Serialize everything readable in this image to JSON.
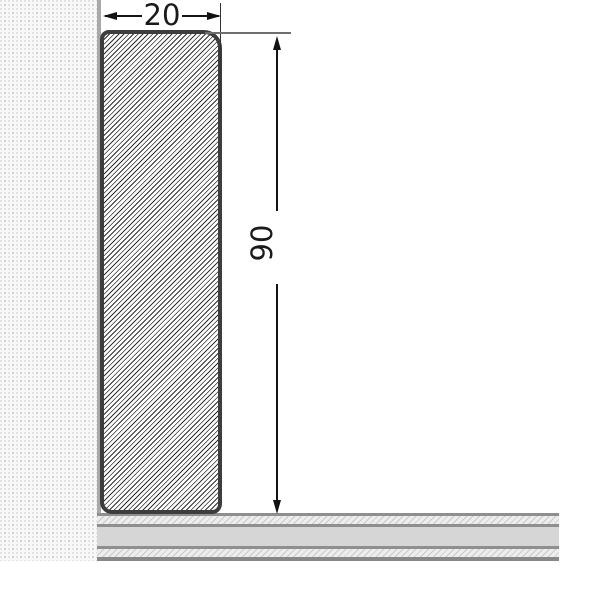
{
  "diagram": {
    "type": "skirting-board-cross-section",
    "dimensions": {
      "width_label": "20",
      "height_label": "90"
    },
    "parts": {
      "wall": "stippled wall plaster texture",
      "wall_surface": "wall surface line",
      "skirting": "hatched skirting board profile with rounded top edge",
      "floor": "layered floor panel cross-section"
    },
    "colors": {
      "background": "#ffffff",
      "profile_outline": "#3d3d3d",
      "profile_hatch": "#2f2f2f",
      "dimension_text": "#1a1a1a",
      "dimension_line": "#141414",
      "extension_line": "#6e6e6e",
      "wall_background": "#f8f8f8",
      "wall_dots": "#c6c6c6",
      "wall_surface_line": "#a9a9a9",
      "floor_border": "#8f8f8f",
      "floor_core": "#d6d6d6",
      "floor_hatch_bg": "#ededed",
      "floor_hatch_line": "#c9c9c9"
    }
  }
}
